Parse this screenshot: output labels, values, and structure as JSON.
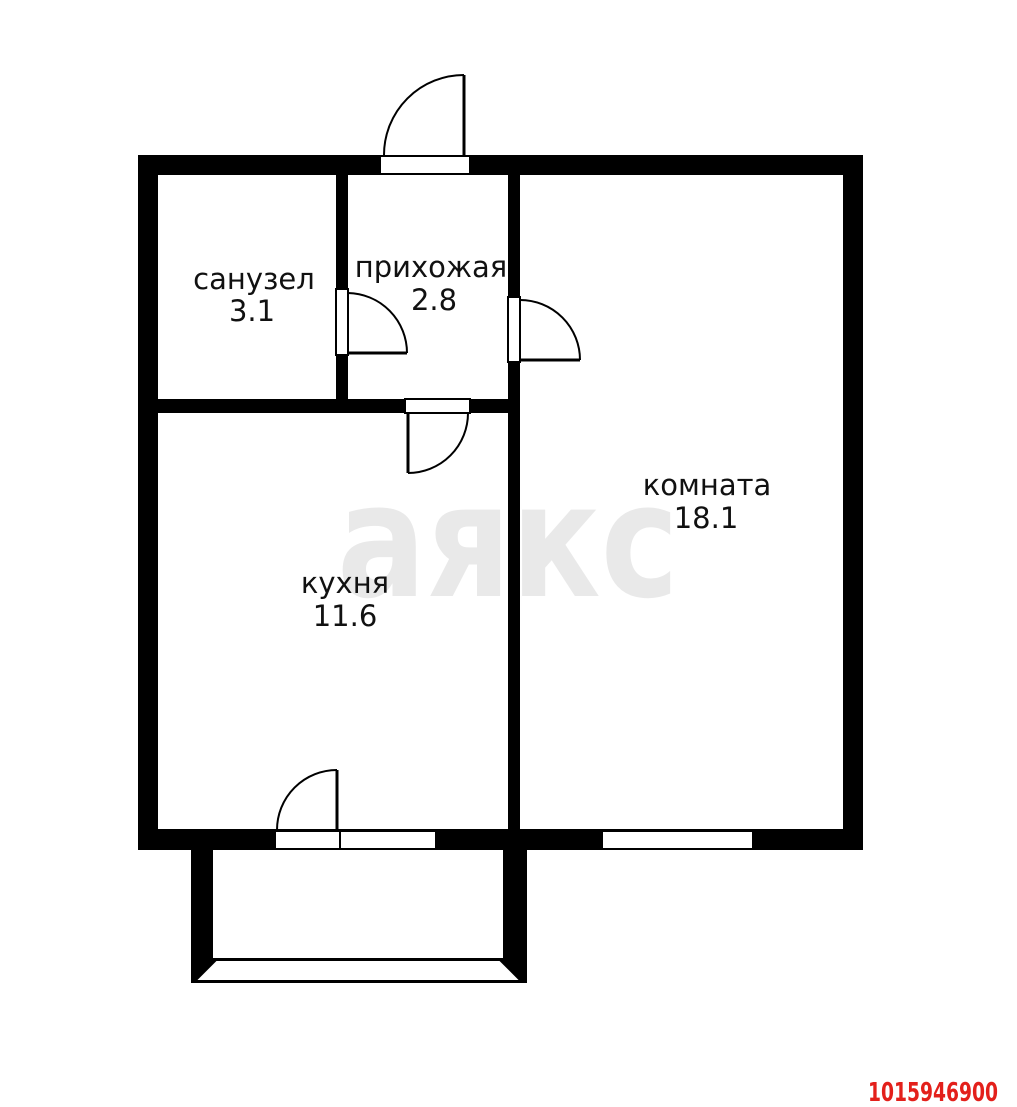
{
  "floorplan": {
    "rooms": [
      {
        "name": "санузел",
        "area": "3.1"
      },
      {
        "name": "прихожая",
        "area": "2.8"
      },
      {
        "name": "комната",
        "area": "18.1"
      },
      {
        "name": "кухня",
        "area": "11.6"
      }
    ],
    "features": {
      "doors": [
        "entrance-door",
        "bathroom-door",
        "hall-room-door",
        "hall-kitchen-door",
        "kitchen-balcony-door"
      ],
      "windows": [
        "room-window",
        "balcony-block-window"
      ],
      "balcony": "balcony"
    },
    "watermark": "аякс",
    "listing_id": "1015946900",
    "colors": {
      "wall": "#000000",
      "background": "#ffffff",
      "label": "#111111",
      "watermark": "#e9e9e9",
      "listing_id_red": "#e3201b"
    }
  }
}
